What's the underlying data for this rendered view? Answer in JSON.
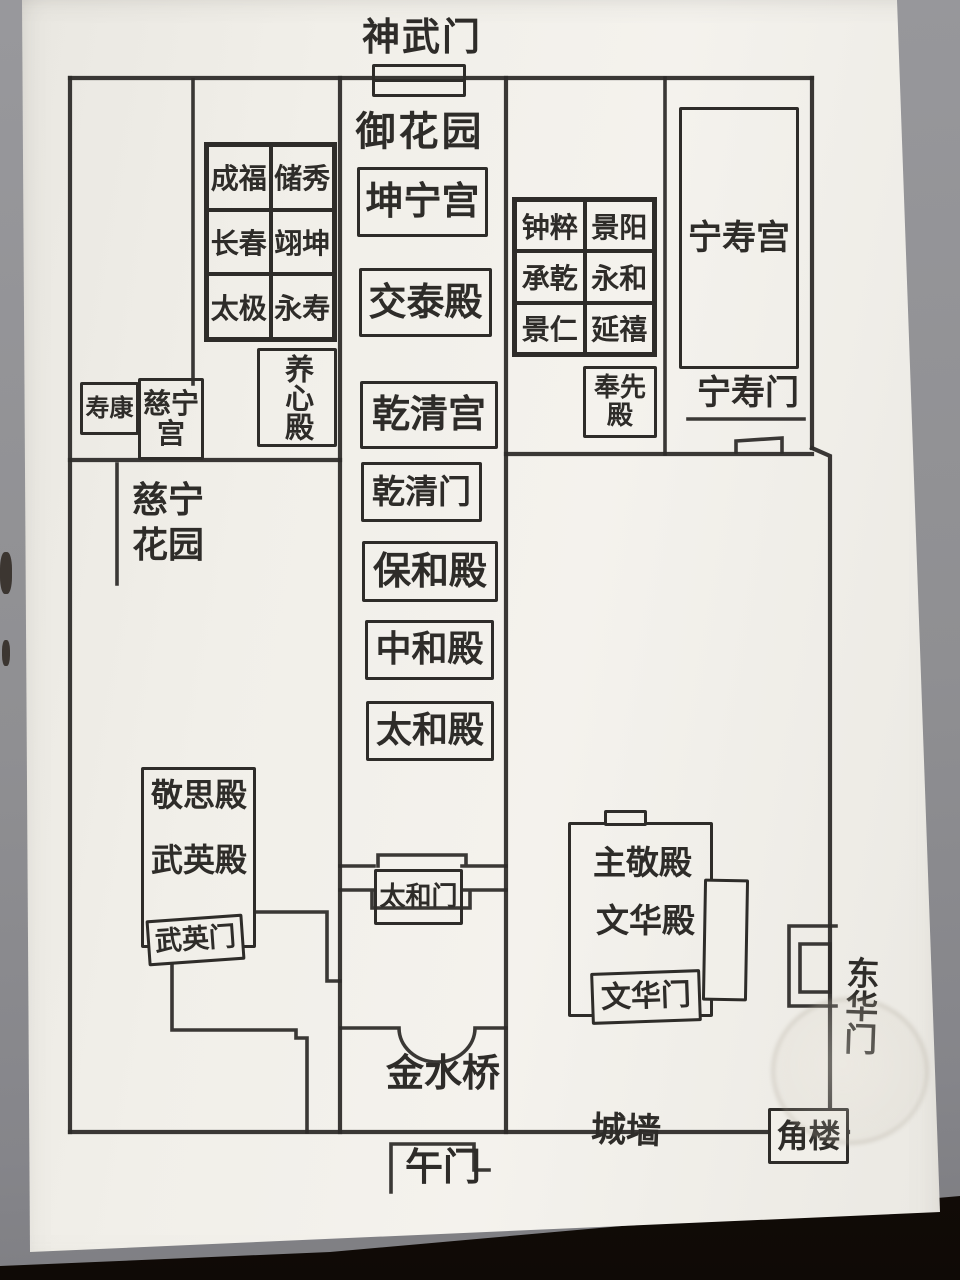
{
  "labels": {
    "shenwumen": "神武门",
    "yuhuayuan": "御花园",
    "kunninggong": "坤宁宫",
    "jiaotaidian": "交泰殿",
    "qianqinggong": "乾清宫",
    "qianqingmen": "乾清门",
    "baohedian": "保和殿",
    "zhonghedian": "中和殿",
    "taihedian": "太和殿",
    "taihemen": "太和门",
    "jinshuiqiao": "金水桥",
    "wumen": "午门",
    "chengqiang": "城墙",
    "jiaolou": "角楼",
    "donghuamen": "东华门",
    "zhujingdian": "主敬殿",
    "wenhuadian": "文华殿",
    "wenhuamen": "文华门",
    "jingsidian": "敬思殿",
    "wuyingdian": "武英殿",
    "wuyingmen": "武英门",
    "yangxindian": "养心殿",
    "shoukanggong": "寿康",
    "cininggong": "慈宁宫",
    "cininghuayuan": "慈宁花园",
    "fengxiandian": "奉先殿",
    "ningshougong": "宁寿宫",
    "ningshoumen": "宁寿门"
  },
  "west_six_palaces": [
    [
      "成福",
      "储秀"
    ],
    [
      "长春",
      "翊坤"
    ],
    [
      "太极",
      "永寿"
    ]
  ],
  "east_six_palaces": [
    [
      "钟粹",
      "景阳"
    ],
    [
      "承乾",
      "永和"
    ],
    [
      "景仁",
      "延禧"
    ]
  ],
  "ink_color": "#2e2c29"
}
